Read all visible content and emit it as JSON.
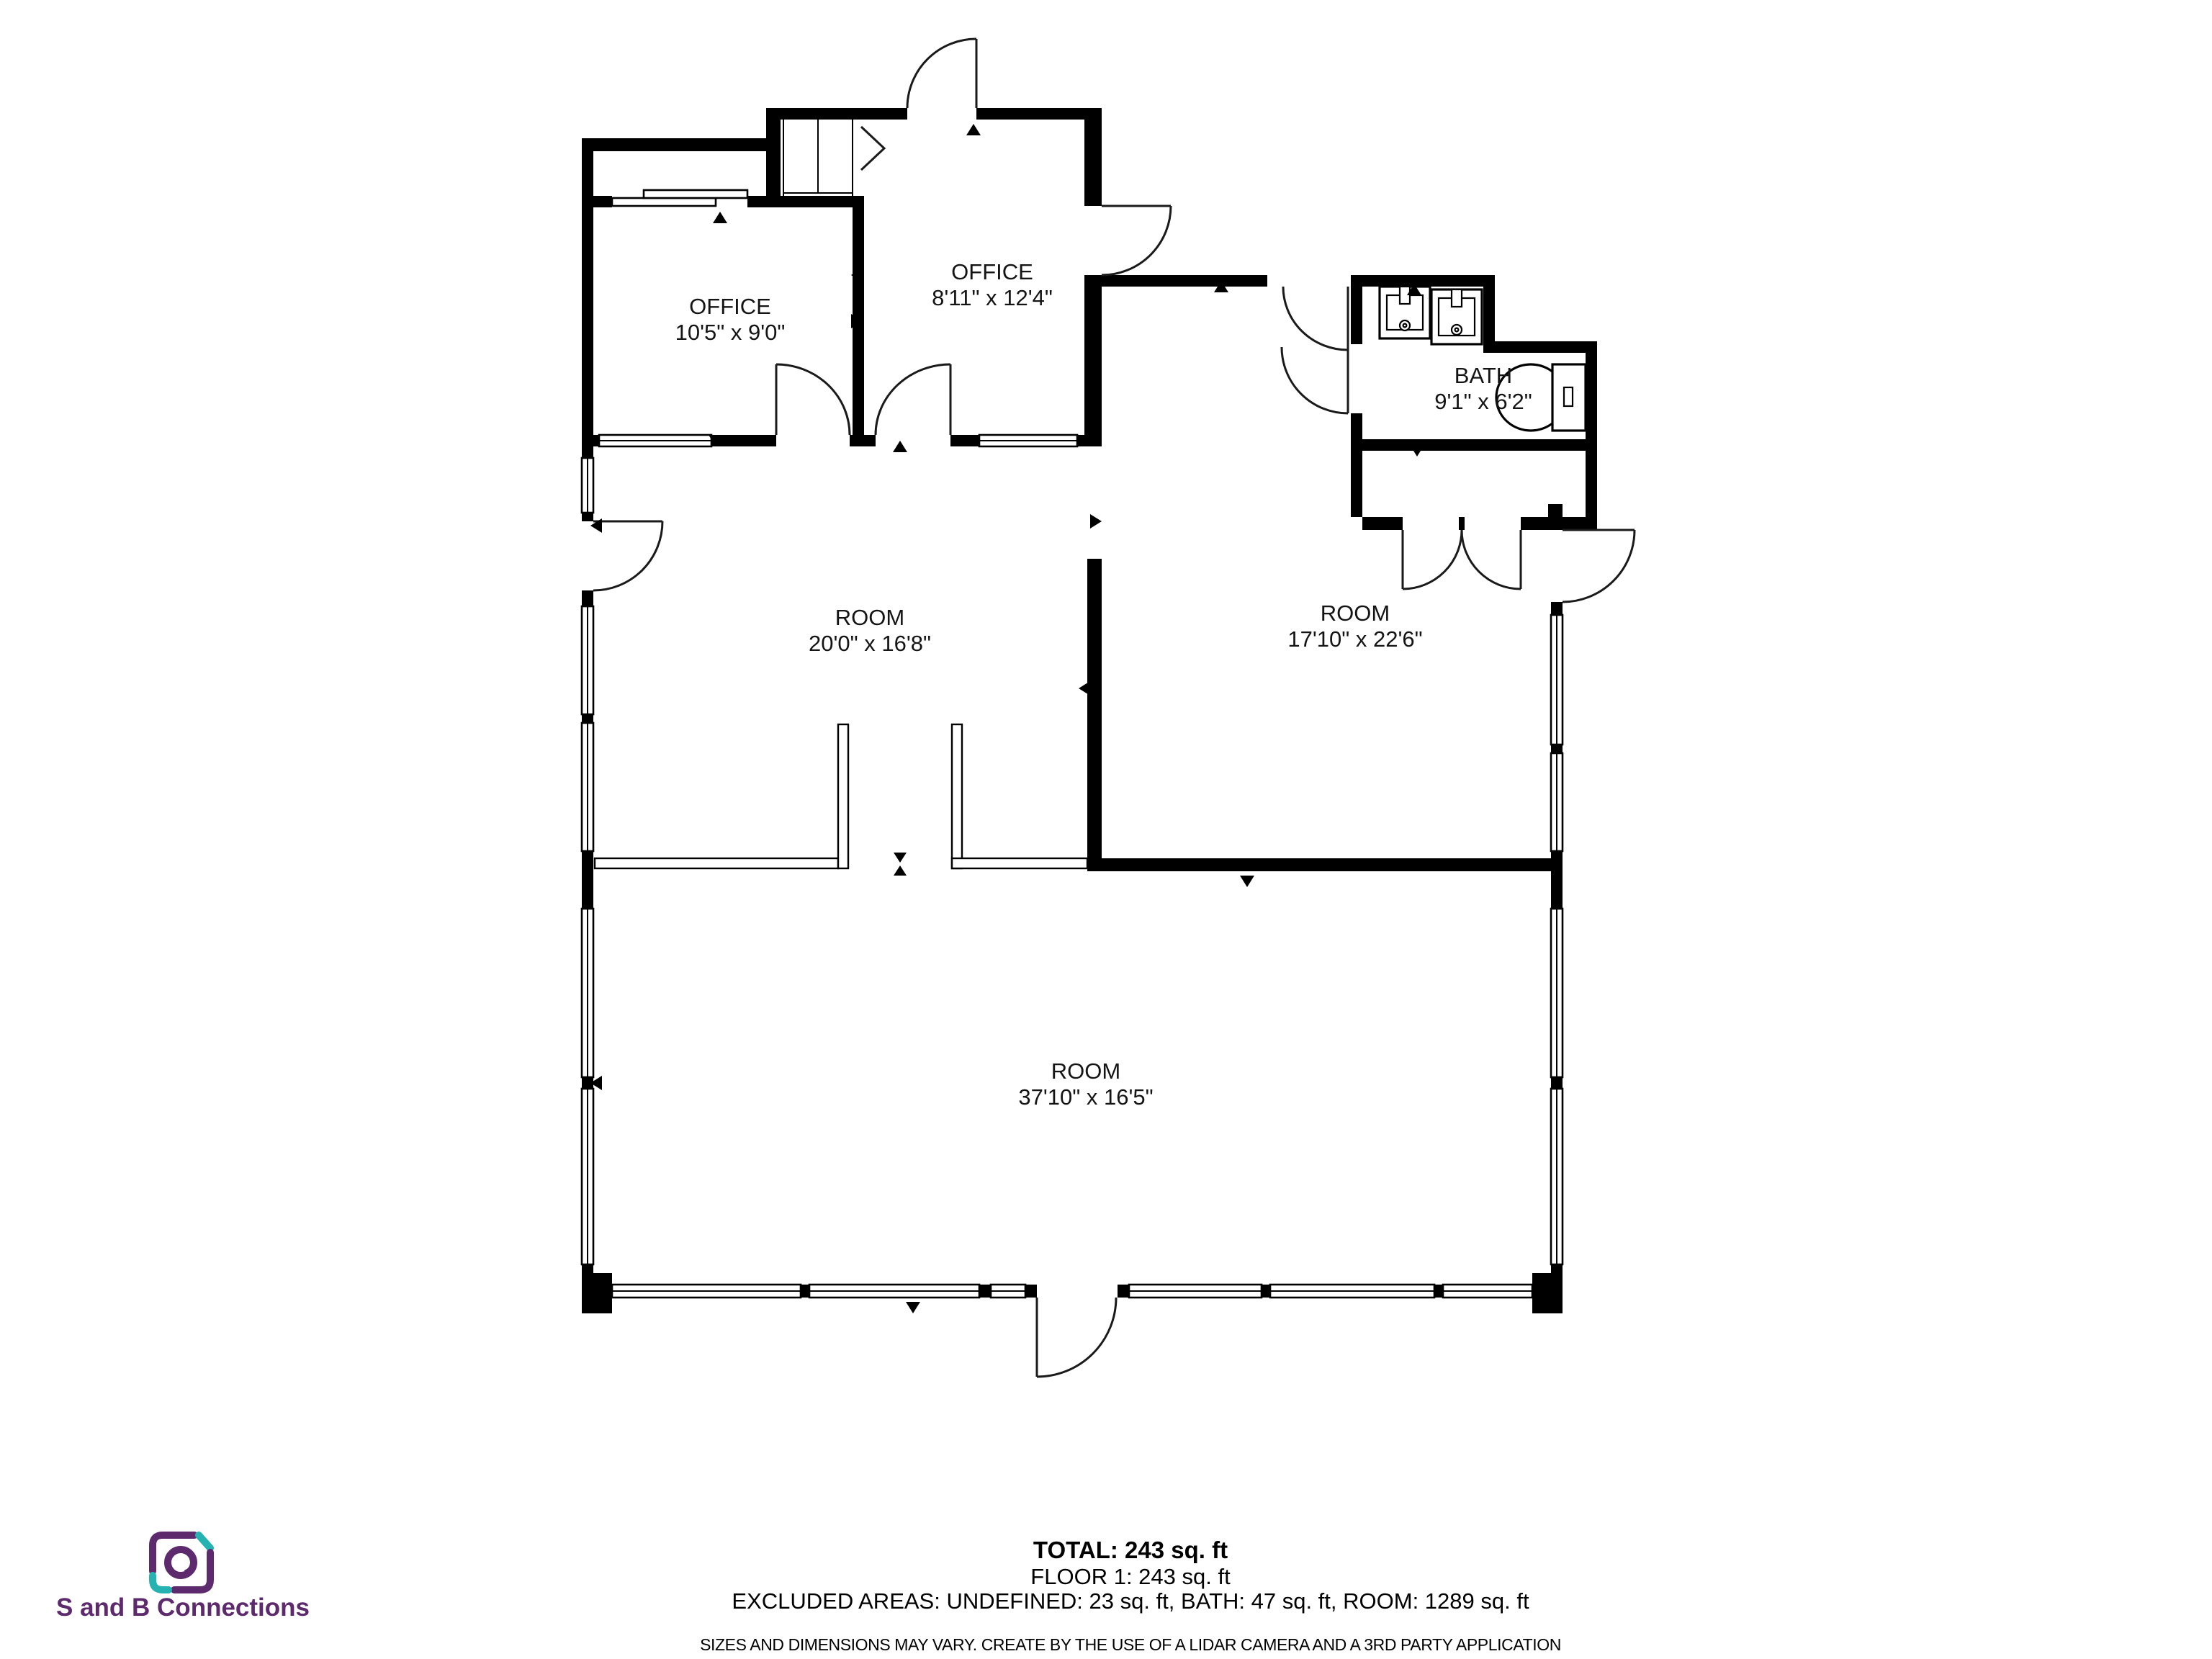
{
  "floorplan": {
    "rooms": {
      "office_left": {
        "name": "OFFICE",
        "dims": "10'5\" x 9'0\""
      },
      "office_top": {
        "name": "OFFICE",
        "dims": "8'11\" x 12'4\""
      },
      "bath": {
        "name": "BATH",
        "dims": "9'1\" x 6'2\""
      },
      "room_middle": {
        "name": "ROOM",
        "dims": "20'0\" x 16'8\""
      },
      "room_right": {
        "name": "ROOM",
        "dims": "17'10\" x 22'6\""
      },
      "room_bottom": {
        "name": "ROOM",
        "dims": "37'10\" x 16'5\""
      }
    }
  },
  "summary": {
    "total": "TOTAL: 243 sq. ft",
    "floor": "FLOOR 1: 243 sq. ft",
    "excluded": "EXCLUDED AREAS: UNDEFINED: 23 sq. ft, BATH: 47 sq. ft, ROOM: 1289 sq. ft",
    "disclaimer": "SIZES AND DIMENSIONS MAY VARY. CREATE BY THE USE OF A LIDAR CAMERA AND A 3RD PARTY APPLICATION"
  },
  "branding": {
    "company": "S and B Connections",
    "colors": {
      "purple": "#5e2a6e",
      "teal": "#25b2b0"
    }
  }
}
